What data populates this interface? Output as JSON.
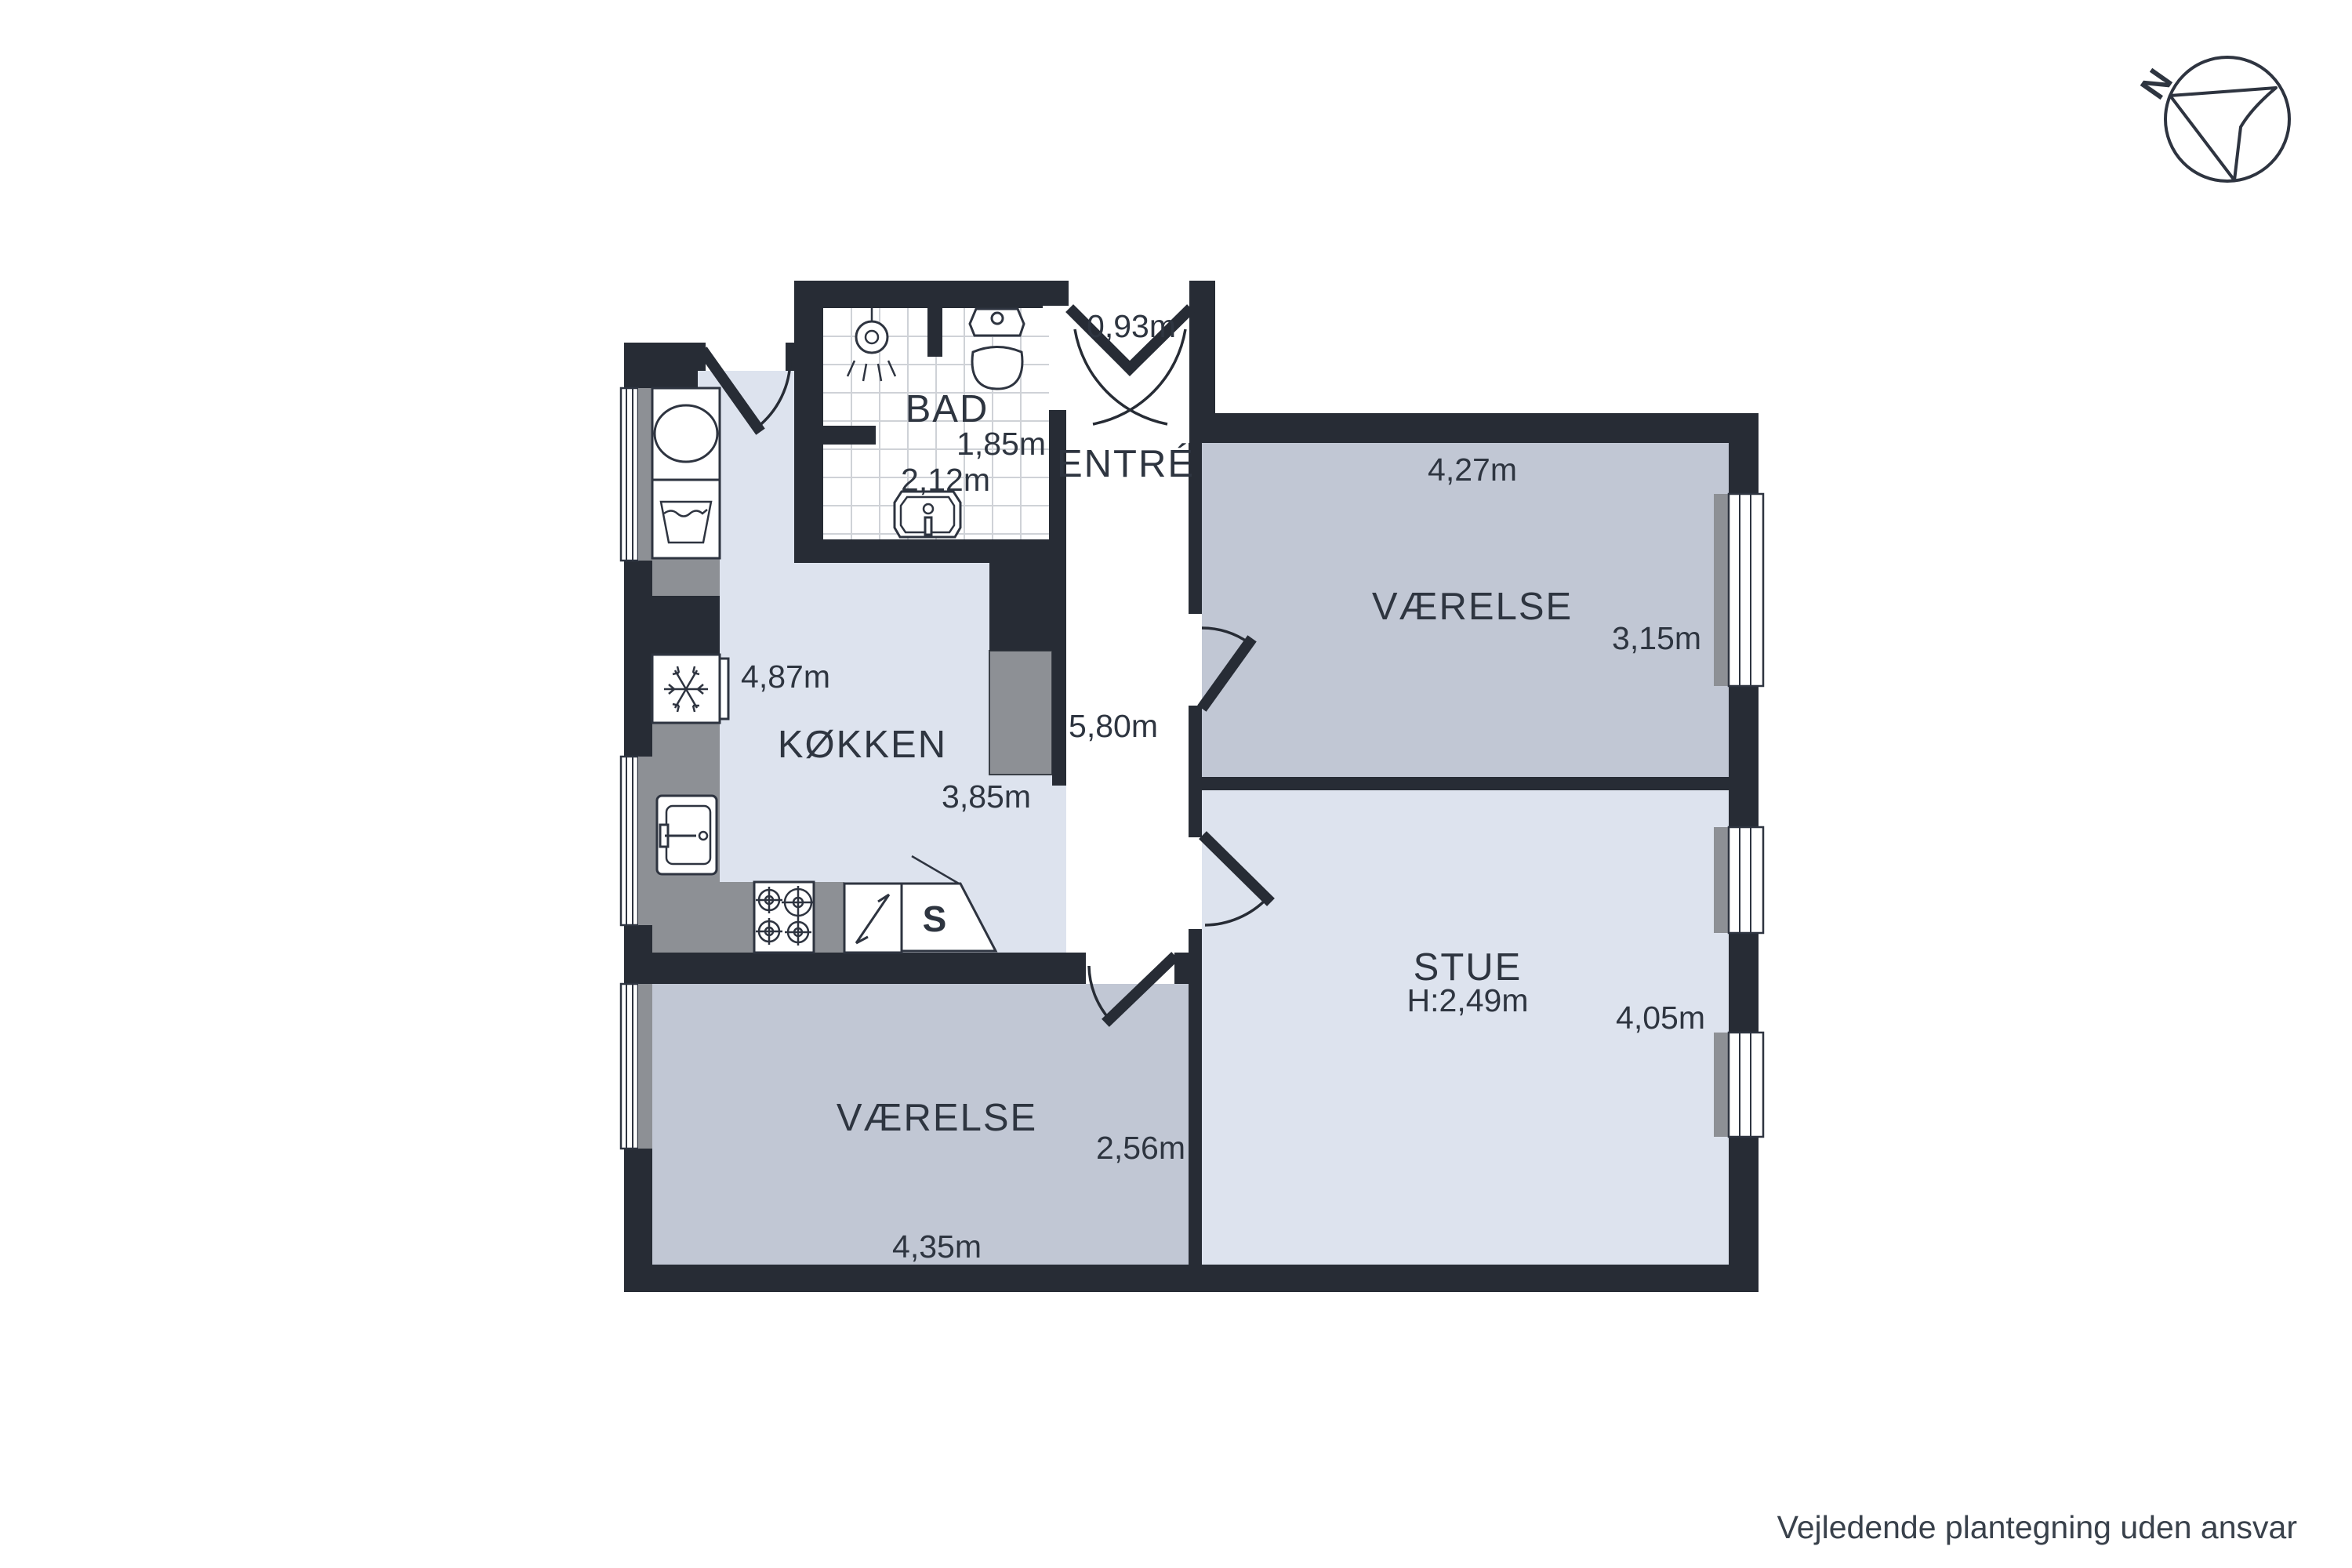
{
  "compass": {
    "north_label": "N"
  },
  "footer": {
    "disclaimer": "Vejledende plantegning uden ansvar"
  },
  "rooms": {
    "bad": {
      "label": "BAD",
      "width": "1,85m",
      "depth": "2,12m"
    },
    "entre": {
      "label": "ENTRÉ",
      "door_width": "0,93m",
      "length": "5,80m"
    },
    "kokken": {
      "label": "KØKKEN",
      "length": "4,87m",
      "width": "3,85m"
    },
    "vaerelse_top": {
      "label": "VÆRELSE",
      "width": "4,27m",
      "depth": "3,15m"
    },
    "stue": {
      "label": "STUE",
      "ceiling_height": "H:2,49m",
      "depth": "4,05m"
    },
    "vaerelse_bottom": {
      "label": "VÆRELSE",
      "depth": "2,56m",
      "width": "4,35m"
    },
    "cabinet": {
      "label": "S"
    }
  },
  "colors": {
    "wall": "#272c35",
    "ink": "#2e3540",
    "footer_ink": "#39414b",
    "room_light": "#dde3ee",
    "room_mid": "#c1c7d4",
    "corridor": "#ffffff",
    "counter": "#8d9095",
    "tile_line": "#cfd2d7",
    "fixture": "#2e3440"
  }
}
